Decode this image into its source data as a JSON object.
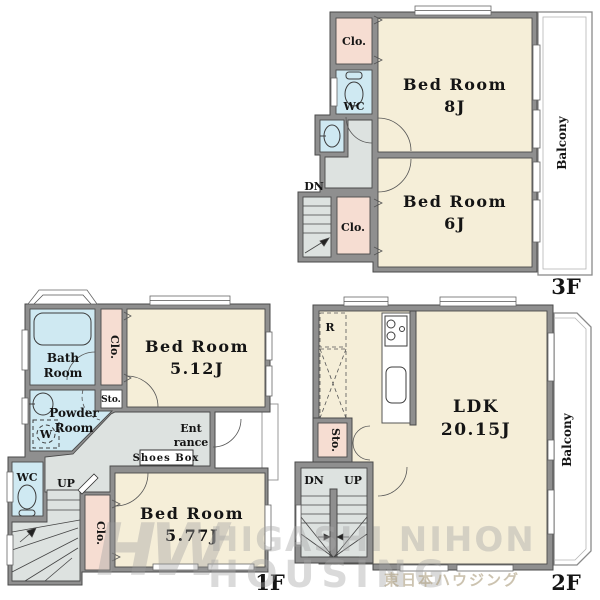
{
  "floors": {
    "f3": {
      "label": "3F",
      "bed8": {
        "name": "Bed Room",
        "size": "8J"
      },
      "bed6": {
        "name": "Bed Room",
        "size": "6J"
      },
      "clo_top": "Clo.",
      "clo_bottom": "Clo.",
      "wc": "WC",
      "dn": "DN",
      "balcony": "Balcony"
    },
    "f2": {
      "label": "2F",
      "ldk": {
        "name": "LDK",
        "size": "20.15J"
      },
      "fridge": "R",
      "sto": "Sto.",
      "dn": "DN",
      "up": "UP",
      "balcony": "Balcony"
    },
    "f1": {
      "label": "1F",
      "bath_l1": "Bath",
      "bath_l2": "Room",
      "clo_top": "Clo.",
      "sto": "Sto.",
      "powder_l1": "Powder",
      "powder_l2": "Room",
      "washer": "W",
      "bed512": {
        "name": "Bed Room",
        "size": "5.12J"
      },
      "ent_l1": "Ent",
      "ent_l2": "rance",
      "shoes": "Shoes Box",
      "wc": "WC",
      "up": "UP",
      "clo_bottom": "Clo.",
      "bed577": {
        "name": "Bed Room",
        "size": "5.77J"
      }
    }
  },
  "watermark": {
    "logo": "HW",
    "line1": "HIGASHI NIHON",
    "line2": "HOUSING",
    "jp": "東日本ハウジング"
  },
  "colors": {
    "wall": "#8f8f8f",
    "line": "#4a4a4a",
    "room": "#f5eed8",
    "closet": "#f6ddd2",
    "wet": "#cfe9f2",
    "hall": "#dde2e0"
  }
}
